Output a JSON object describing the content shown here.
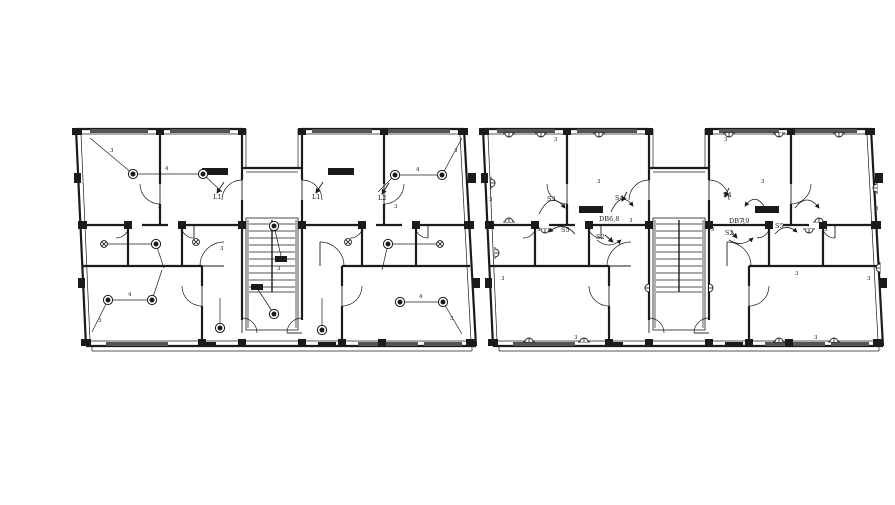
{
  "page": {
    "background": "#ffffff"
  },
  "drawing": {
    "ink": "#1b1b1b",
    "window_fill": "#555555",
    "width": 895,
    "height": 505,
    "template": {
      "walls2": [
        [
          4,
          1,
          170,
          1
        ],
        [
          230,
          1,
          392,
          1
        ],
        [
          170,
          1,
          170,
          40
        ],
        [
          230,
          1,
          230,
          40
        ],
        [
          170,
          40,
          230,
          40
        ],
        [
          392,
          1,
          404,
          218
        ],
        [
          14,
          218,
          404,
          218
        ],
        [
          4,
          1,
          14,
          218
        ],
        [
          10,
          97,
          56,
          97
        ],
        [
          70,
          97,
          96,
          97
        ],
        [
          110,
          97,
          170,
          97
        ],
        [
          230,
          97,
          290,
          97
        ],
        [
          304,
          97,
          330,
          97
        ],
        [
          344,
          97,
          396,
          97
        ],
        [
          88,
          1,
          88,
          56
        ],
        [
          88,
          76,
          88,
          97
        ],
        [
          312,
          1,
          312,
          56
        ],
        [
          312,
          76,
          312,
          97
        ],
        [
          170,
          40,
          170,
          52
        ],
        [
          170,
          72,
          170,
          192
        ],
        [
          230,
          40,
          230,
          52
        ],
        [
          230,
          72,
          230,
          192
        ],
        [
          56,
          97,
          56,
          138
        ],
        [
          110,
          97,
          110,
          138
        ],
        [
          290,
          97,
          290,
          138
        ],
        [
          344,
          97,
          344,
          138
        ],
        [
          11,
          138,
          130,
          138
        ],
        [
          270,
          138,
          398,
          138
        ],
        [
          130,
          138,
          130,
          158
        ],
        [
          130,
          178,
          130,
          218
        ],
        [
          270,
          138,
          270,
          158
        ],
        [
          270,
          178,
          270,
          218
        ]
      ],
      "walls1": [
        [
          8,
          6,
          166,
          6
        ],
        [
          234,
          6,
          388,
          6
        ],
        [
          174,
          1,
          174,
          40
        ],
        [
          226,
          1,
          226,
          40
        ],
        [
          174,
          44,
          226,
          44
        ],
        [
          9,
          6,
          18,
          213
        ],
        [
          388,
          6,
          399,
          213
        ],
        [
          18,
          213,
          399,
          213
        ],
        [
          20,
          223,
          400,
          223
        ],
        [
          20,
          218,
          20,
          223
        ],
        [
          400,
          218,
          400,
          223
        ],
        [
          176,
          92,
          176,
          200
        ],
        [
          224,
          92,
          224,
          200
        ]
      ],
      "windows": [
        [
          18,
          1,
          58,
          4
        ],
        [
          98,
          1,
          60,
          4
        ],
        [
          240,
          1,
          60,
          4
        ],
        [
          314,
          1,
          64,
          4
        ],
        [
          34,
          214,
          62,
          4
        ],
        [
          286,
          214,
          60,
          4
        ],
        [
          352,
          214,
          38,
          4
        ]
      ],
      "bars": [
        [
          0,
          0,
          10,
          7
        ],
        [
          84,
          0,
          8,
          7
        ],
        [
          166,
          0,
          8,
          7
        ],
        [
          226,
          0,
          8,
          7
        ],
        [
          308,
          0,
          8,
          7
        ],
        [
          386,
          0,
          10,
          7
        ],
        [
          6,
          93,
          9,
          8
        ],
        [
          52,
          93,
          8,
          8
        ],
        [
          106,
          93,
          8,
          8
        ],
        [
          166,
          93,
          8,
          8
        ],
        [
          226,
          93,
          8,
          8
        ],
        [
          286,
          93,
          8,
          8
        ],
        [
          340,
          93,
          8,
          8
        ],
        [
          392,
          93,
          10,
          8
        ],
        [
          9,
          211,
          10,
          7
        ],
        [
          126,
          211,
          8,
          7
        ],
        [
          166,
          211,
          8,
          7
        ],
        [
          226,
          211,
          8,
          7
        ],
        [
          266,
          211,
          8,
          7
        ],
        [
          306,
          211,
          8,
          7
        ],
        [
          394,
          211,
          10,
          7
        ],
        [
          2,
          45,
          7,
          10
        ],
        [
          396,
          45,
          8,
          10
        ],
        [
          6,
          150,
          7,
          10
        ],
        [
          400,
          150,
          8,
          10
        ],
        [
          126,
          214,
          18,
          5
        ],
        [
          246,
          214,
          18,
          5
        ]
      ],
      "stairs": [
        [
          174,
          90,
          52,
          112,
          10
        ]
      ],
      "doors": [
        [
          170,
          72,
          20,
          270,
          180
        ],
        [
          230,
          72,
          20,
          270,
          360
        ],
        [
          88,
          56,
          20,
          90,
          180
        ],
        [
          312,
          56,
          20,
          90,
          0
        ],
        [
          44,
          97,
          13,
          0,
          90
        ],
        [
          122,
          97,
          13,
          90,
          180
        ],
        [
          130,
          158,
          20,
          90,
          180
        ],
        [
          270,
          158,
          20,
          90,
          0
        ],
        [
          170,
          205,
          15,
          270,
          360
        ],
        [
          230,
          205,
          15,
          180,
          270
        ],
        [
          356,
          97,
          13,
          90,
          180
        ],
        [
          278,
          97,
          13,
          0,
          90
        ],
        [
          152,
          138,
          24,
          180,
          270
        ],
        [
          248,
          138,
          24,
          270,
          360
        ]
      ]
    },
    "plans": [
      {
        "name": "lighting-layout-plan",
        "origin": [
          72,
          128
        ],
        "overlay": {
          "bars": [
            [
              130,
              40,
              26,
              7
            ],
            [
              256,
              40,
              26,
              7
            ],
            [
              203,
              128,
              12,
              6
            ],
            [
              179,
              156,
              12,
              6
            ]
          ],
          "lights": [
            [
              61,
              46
            ],
            [
              131,
              46
            ],
            [
              84,
              116
            ],
            [
              36,
              172
            ],
            [
              80,
              172
            ],
            [
              148,
              200
            ],
            [
              202,
              98
            ],
            [
              202,
              186
            ],
            [
              323,
              47
            ],
            [
              370,
              47
            ],
            [
              316,
              116
            ],
            [
              328,
              174
            ],
            [
              371,
              174
            ],
            [
              250,
              202
            ]
          ],
          "fans": [
            [
              32,
              116
            ],
            [
              124,
              114
            ],
            [
              368,
              116
            ],
            [
              276,
              114
            ]
          ],
          "wires": [
            [
              18,
              10,
              61,
              46
            ],
            [
              61,
              46,
              131,
              46
            ],
            [
              131,
              46,
              150,
              64
            ],
            [
              32,
              116,
              84,
              116
            ],
            [
              84,
              116,
              92,
              140
            ],
            [
              36,
              172,
              80,
              172
            ],
            [
              36,
              172,
              20,
              204
            ],
            [
              80,
              172,
              90,
              142
            ],
            [
              148,
              200,
              148,
              170
            ],
            [
              202,
              98,
              209,
              128
            ],
            [
              202,
              186,
              185,
              160
            ],
            [
              323,
              47,
              370,
              47
            ],
            [
              370,
              47,
              390,
              10
            ],
            [
              323,
              47,
              306,
              64
            ],
            [
              316,
              116,
              368,
              116
            ],
            [
              316,
              116,
              310,
              142
            ],
            [
              328,
              174,
              371,
              174
            ],
            [
              371,
              174,
              390,
              206
            ],
            [
              250,
              202,
              250,
              170
            ]
          ],
          "texts": [
            [
              "L1",
              141,
              71
            ],
            [
              "L1",
              240,
              71
            ],
            [
              "L2",
              306,
              72
            ]
          ],
          "arrows": [
            [
              152,
              54,
              145,
              65
            ],
            [
              251,
              54,
              244,
              65
            ],
            [
              317,
              55,
              310,
              66
            ]
          ],
          "wire_labels": [
            [
              "4",
              93,
              42
            ],
            [
              "3",
              38,
              24
            ],
            [
              "4",
              56,
              168
            ],
            [
              "3",
              26,
              194
            ],
            [
              "4",
              344,
              43
            ],
            [
              "3",
              382,
              24
            ],
            [
              "4",
              347,
              170
            ],
            [
              "3",
              378,
              192
            ],
            [
              "3",
              205,
              142
            ],
            [
              "3",
              148,
              122
            ],
            [
              "3",
              86,
              80
            ],
            [
              "3",
              322,
              80
            ]
          ]
        }
      },
      {
        "name": "power-layout-plan",
        "origin": [
          479,
          128
        ],
        "overlay": {
          "bars": [
            [
              100,
              78,
              24,
              7
            ],
            [
              276,
              78,
              24,
              7
            ]
          ],
          "sockets": [
            [
              30,
              5,
              0
            ],
            [
              62,
              5,
              0
            ],
            [
              120,
              5,
              0
            ],
            [
              250,
              5,
              0
            ],
            [
              300,
              5,
              0
            ],
            [
              360,
              5,
              0
            ],
            [
              50,
              214,
              180
            ],
            [
              105,
              214,
              180
            ],
            [
              300,
              214,
              180
            ],
            [
              355,
              214,
              180
            ],
            [
              12,
              55,
              270
            ],
            [
              16,
              125,
              270
            ],
            [
              398,
              60,
              90
            ],
            [
              401,
              140,
              90
            ],
            [
              30,
              94,
              180
            ],
            [
              340,
              94,
              180
            ],
            [
              66,
              101,
              0
            ],
            [
              330,
              101,
              0
            ],
            [
              230,
              160,
              270
            ],
            [
              170,
              160,
              90
            ]
          ],
          "curves": [
            "M60,86 Q72,62 86,80",
            "M132,84 Q142,62 154,78",
            "M96,106 Q84,92 70,104",
            "M118,112 Q130,122 142,112",
            "M288,84 Q278,62 266,78",
            "M316,80 Q328,64 340,80",
            "M250,112 Q262,120 274,110",
            "M296,106 Q306,94 318,104"
          ],
          "texts": [
            [
              "S3",
              68,
              73
            ],
            [
              "S4",
              136,
              72
            ],
            [
              "DB6,8",
              120,
              93
            ],
            [
              "S5",
              82,
              104
            ],
            [
              "S2",
              117,
              111
            ],
            [
              "S4",
              244,
              69
            ],
            [
              "DB7,9",
              250,
              95
            ],
            [
              "S2",
              246,
              107
            ],
            [
              "S5",
              296,
              100
            ]
          ],
          "arrows": [
            [
              126,
              107,
              134,
              114
            ],
            [
              252,
              103,
              258,
              110
            ],
            [
              148,
              64,
              143,
              73
            ],
            [
              250,
              60,
              246,
              69
            ]
          ],
          "wire_labels": [
            [
              "3",
              75,
              13
            ],
            [
              "3",
              245,
              13
            ],
            [
              "3",
              10,
              73
            ],
            [
              "3",
              396,
              82
            ],
            [
              "3",
              58,
              103
            ],
            [
              "3",
              232,
              103
            ],
            [
              "3",
              345,
              103
            ],
            [
              "3",
              388,
              152
            ],
            [
              "3",
              22,
              152
            ],
            [
              "3",
              95,
              211
            ],
            [
              "3",
              335,
              211
            ],
            [
              "3",
              150,
              94
            ],
            [
              "3",
              262,
              94
            ],
            [
              "3",
              316,
              147
            ],
            [
              "3",
              118,
              55
            ],
            [
              "3",
              282,
              55
            ]
          ]
        }
      }
    ]
  }
}
